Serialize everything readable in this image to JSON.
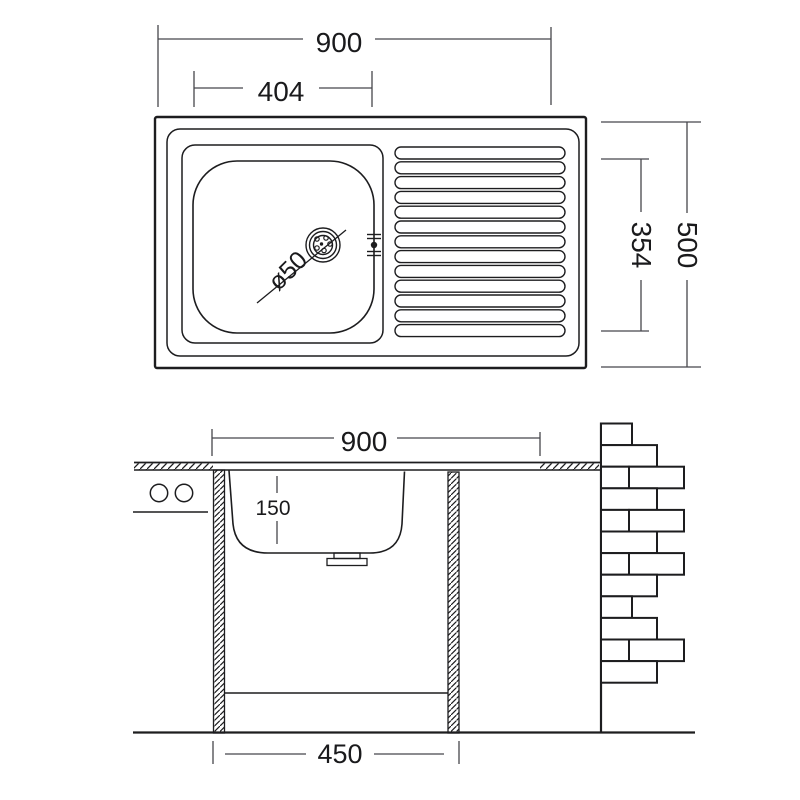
{
  "drawing": {
    "title": "kitchen-sink-technical-drawing",
    "colors": {
      "line": "#1d1d1f",
      "dim": "#46464c",
      "background": "#ffffff"
    },
    "top_view": {
      "dim_width_total": "900",
      "dim_bowl_width": "404",
      "dim_depth_total": "500",
      "dim_bowl_depth": "354",
      "drain_label": "ø50",
      "drainboard_ridges": 13
    },
    "section_view": {
      "dim_width_total": "900",
      "dim_bowl_depth": "150",
      "dim_cabinet_width": "450",
      "brick_rows": [
        "small",
        "wide",
        "pair",
        "wide",
        "pair",
        "wide",
        "pair",
        "wide",
        "small",
        "wide",
        "pair",
        "wide"
      ]
    }
  }
}
